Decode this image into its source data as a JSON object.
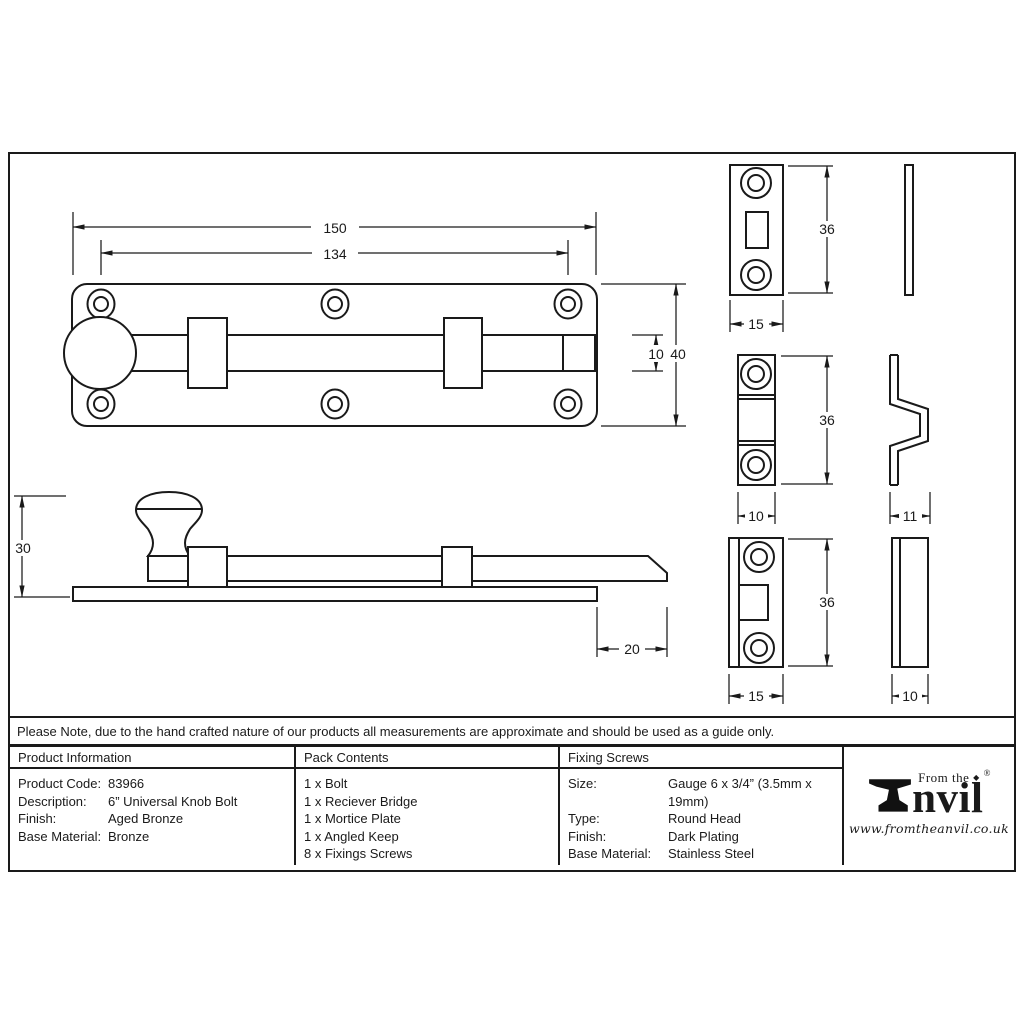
{
  "note": "Please Note, due to the hand crafted nature of our products all measurements are approximate and should be used as a guide only.",
  "drawing": {
    "dims": {
      "top_length": "150",
      "hole_span": "134",
      "bolt_dia": "10",
      "plate_width": "40",
      "side_height": "30",
      "throw": "20",
      "mortice_height": "36",
      "mortice_width": "15",
      "bridge_height": "36",
      "bridge_width": "10",
      "bridge_depth": "11",
      "keep_height": "36",
      "keep_width": "15",
      "keep_depth": "10"
    }
  },
  "table": {
    "product_information": {
      "header": "Product Information",
      "rows": [
        {
          "label": "Product Code:",
          "value": "83966"
        },
        {
          "label": "Description:",
          "value": "6” Universal Knob Bolt"
        },
        {
          "label": "Finish:",
          "value": "Aged Bronze"
        },
        {
          "label": "Base Material:",
          "value": "Bronze"
        }
      ]
    },
    "pack_contents": {
      "header": "Pack Contents",
      "items": [
        "1 x Bolt",
        "1 x Reciever Bridge",
        "1 x Mortice Plate",
        "1 x Angled Keep",
        "8 x Fixings Screws"
      ]
    },
    "fixing_screws": {
      "header": "Fixing Screws",
      "rows": [
        {
          "label": "Size:",
          "value": "Gauge 6 x 3/4” (3.5mm x 19mm)"
        },
        {
          "label": "Type:",
          "value": "Round Head"
        },
        {
          "label": "Finish:",
          "value": "Dark Plating"
        },
        {
          "label": "Base Material:",
          "value": "Stainless Steel"
        }
      ]
    }
  },
  "logo": {
    "tagline": "From the",
    "diamond": "◆",
    "registered": "®",
    "wordmark_suffix": "nvil",
    "website": "www.fromtheanvil.co.uk"
  },
  "colors": {
    "ink": "#1a1a1a",
    "paper": "#ffffff"
  }
}
